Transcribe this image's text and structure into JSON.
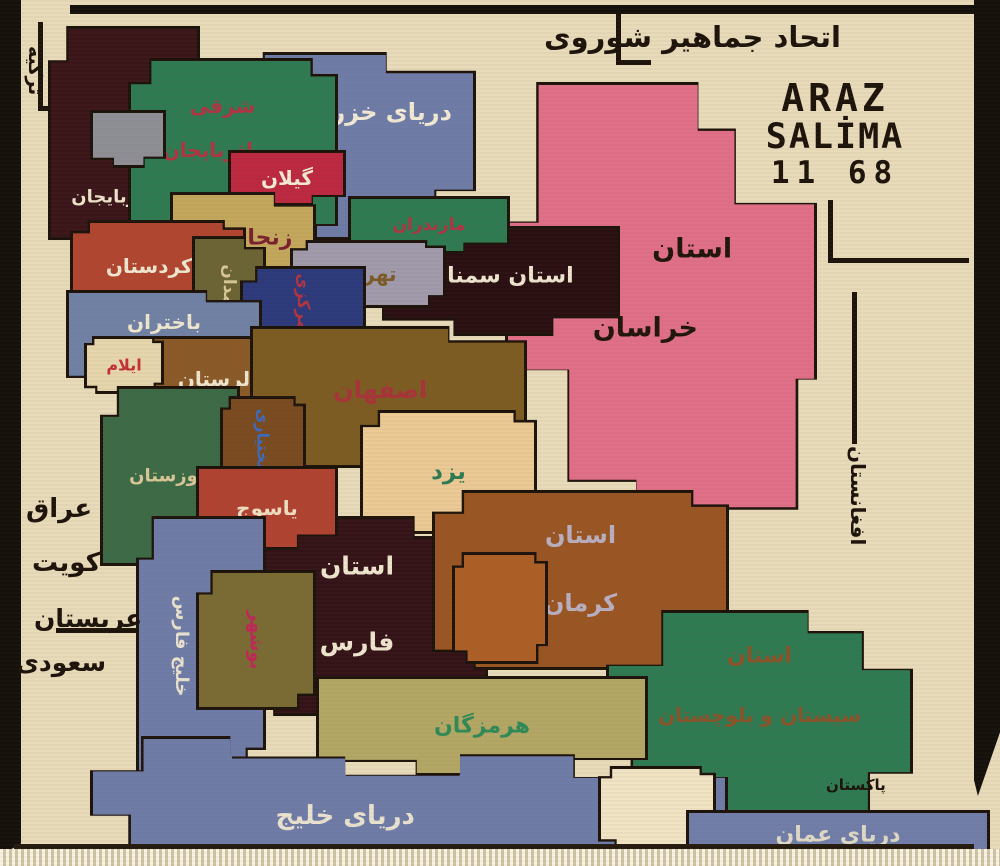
{
  "palette": {
    "carpet_background": "#e8dbba",
    "outline_black": "#1c130b",
    "sea_blue": "#6e7ca7",
    "khorasan_pink": "#e06f88",
    "province_green": "#2e7a52",
    "dark_maroon": "#331318",
    "fringe_white": "#f8f3e3"
  },
  "inscriptions": {
    "soviet_union_top": "اتحاد جماهیر شوروی",
    "signature_line1": "ARAZ",
    "signature_line2": "SALİMA",
    "signature_line3": "11 68"
  },
  "seas": {
    "caspian": {
      "label": "دریای خزر",
      "color": "#6e7ca7",
      "label_color": "#f2ead6"
    },
    "gulf_west": {
      "label": "خلیج فارس",
      "color": "#6e7ca7",
      "label_color": "#e8e2cf"
    },
    "gulf_bottom": {
      "label": "دریای خلیج",
      "color": "#6e7ca7",
      "label_color": "#e8e2cf"
    },
    "oman": {
      "label": "دریای عمان",
      "color": "#707ea9",
      "label_color": "#dfd9c6"
    }
  },
  "provinces": {
    "w_azerbaijan": {
      "label": "اذربایجان",
      "color": "#3a151a",
      "label_color": "#eee4cc"
    },
    "e_azerbaijan": {
      "lines": [
        "شرقی",
        "اذربایجان"
      ],
      "color": "#2e7a52",
      "label_color": "#b23342"
    },
    "gilan": {
      "label": "گیلان",
      "color": "#bb2840",
      "label_color": "#f2ead6"
    },
    "zanjan": {
      "label": "زنجان",
      "color": "#c3a75d",
      "label_color": "#7a2030"
    },
    "kordestan": {
      "label": "کردستان",
      "color": "#b04530",
      "label_color": "#efe6d0"
    },
    "hamadan": {
      "label": "همدان",
      "color": "#6b6434",
      "label_color": "#d9c897"
    },
    "mazandaran": {
      "label": "مازندران",
      "color": "#2e7a52",
      "label_color": "#b23342"
    },
    "tehran": {
      "label": "تهران",
      "color": "#a09aac",
      "label_color": "#7c5a28"
    },
    "markazi": {
      "label": "مرکزی",
      "color": "#2c3a7c",
      "label_color": "#b23342"
    },
    "semnan": {
      "label": "استان سمنان",
      "color": "#2a0f12",
      "label_color": "#efe6d0"
    },
    "khorasan": {
      "lines": [
        "استان",
        "خراسان"
      ],
      "color": "#e06f88",
      "label_color": "#20150d"
    },
    "bakhtaran": {
      "label": "باختران",
      "color": "#7081a6",
      "label_color": "#efe6d0"
    },
    "ilam": {
      "label": "ایلام",
      "color": "#e6d6ae",
      "label_color": "#c23038"
    },
    "lorestan": {
      "label": "لرستان",
      "color": "#8a5a28",
      "label_color": "#efe6d0"
    },
    "isfahan": {
      "label": "اصفهان",
      "color": "#7c5c22",
      "label_color": "#a8333a"
    },
    "khuzestan": {
      "label": "خوزستان",
      "color": "#3c6a46",
      "label_color": "#d9c897"
    },
    "chaharmahal": {
      "label": "بختیاری",
      "color": "#7a4b20",
      "label_color": "#3a6cc4"
    },
    "yazd": {
      "label": "یزد",
      "color": "#ecca96",
      "label_color": "#2e7a52"
    },
    "yasuj": {
      "label": "یاسوج",
      "color": "#b04232",
      "label_color": "#f0dfc2"
    },
    "fars": {
      "lines": [
        "استان",
        "فارس"
      ],
      "color": "#331318",
      "label_color": "#efe6d0"
    },
    "bushehr": {
      "label": "بوشهر",
      "color": "#7a6a34",
      "label_color": "#c22558"
    },
    "kerman": {
      "lines": [
        "استان",
        "کرمان"
      ],
      "color": "#9a5524",
      "label_color": "#b9afc0"
    },
    "sistan": {
      "lines": [
        "استان",
        "سیستان و بلوچستان"
      ],
      "color": "#2e7a52",
      "label_color": "#8a5228"
    },
    "hormozgan": {
      "label": "هرمزگان",
      "color": "#b3a765",
      "label_color": "#2f8a58"
    }
  },
  "neighbors": {
    "turkey": "ترکیه",
    "iraq": "عراق",
    "kuwait": "کویت",
    "saudi_line1": "عربستان",
    "saudi_line2": "سعودی",
    "afghanistan": "افغانستان",
    "pakistan": "پاکستان"
  }
}
